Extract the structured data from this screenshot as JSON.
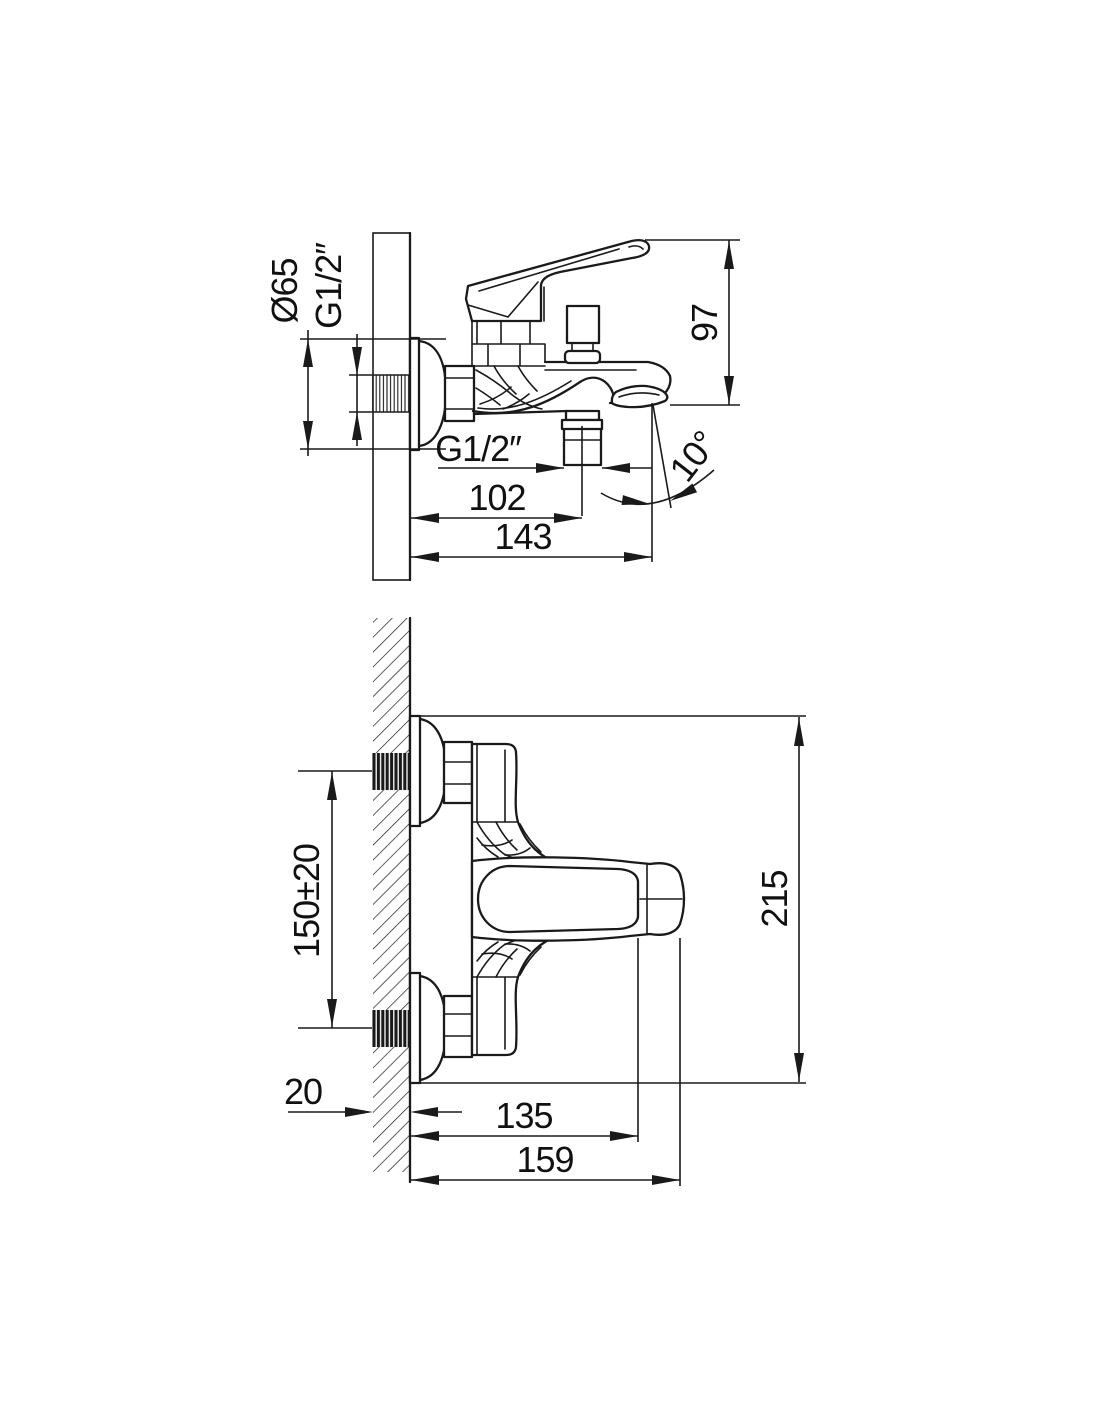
{
  "drawing": {
    "background": "#ffffff",
    "line_color": "#1a1a1a",
    "side_view": {
      "name": "side-elevation-view",
      "dims": {
        "escutcheon_diameter": "Ø65",
        "inlet_thread": "G1/2″",
        "height": "97",
        "shower_outlet_thread": "G1/2″",
        "wall_to_outlet_axis": "102",
        "wall_to_spout_tip": "143",
        "spout_angle": "10°"
      }
    },
    "plan_view": {
      "name": "plan-view",
      "dims": {
        "inlet_spacing": "150±20",
        "overall_span": "215",
        "wall_thickness": "20",
        "wall_to_lever_grip": "135",
        "wall_to_handle_end": "159"
      }
    }
  }
}
